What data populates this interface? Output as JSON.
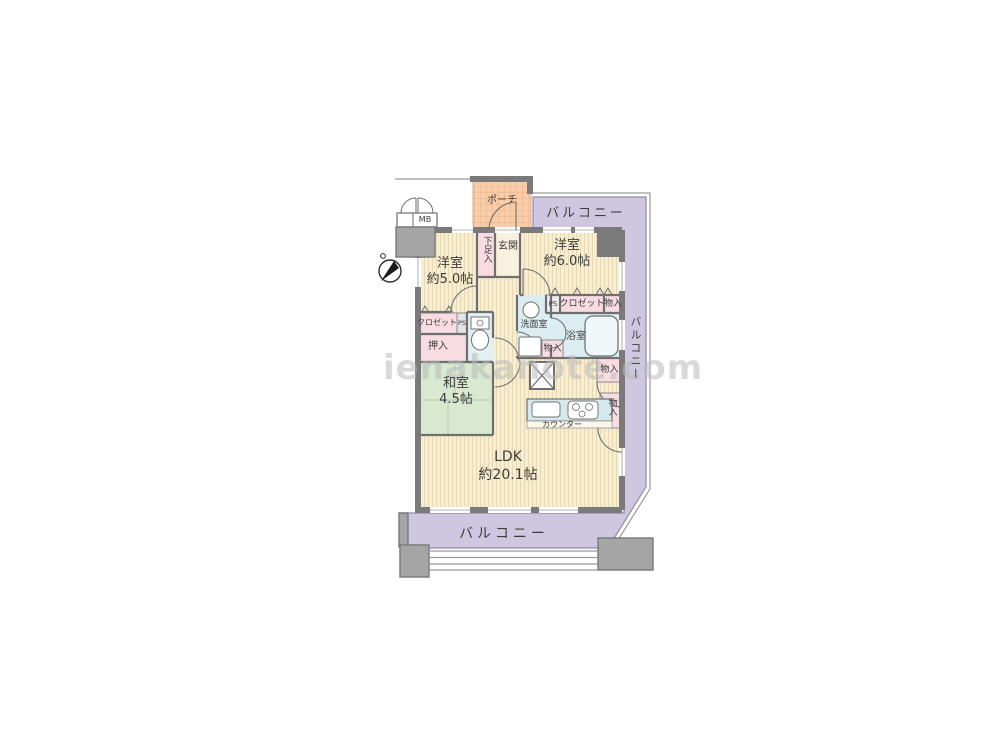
{
  "watermark": "ienakanote.com",
  "rooms": {
    "bedroom1": {
      "name": "洋室",
      "size": "約5.0帖"
    },
    "bedroom2": {
      "name": "洋室",
      "size": "約6.0帖"
    },
    "japanese_room": {
      "name": "和室",
      "size": "4.5帖"
    },
    "ldk": {
      "name": "LDK",
      "size": "約20.1帖"
    },
    "entrance": "玄関",
    "porch": "ポーチ",
    "washroom": "洗面室",
    "bath": "浴室"
  },
  "storage": {
    "shoe_box": "下足入",
    "closet_left": "クロゼット",
    "closet_right": "クロゼット",
    "oshiire": "押入",
    "storage_top_right": "物入",
    "storage_washroom": "物入",
    "storage_mid_right": "物入",
    "storage_kitchen": "物入"
  },
  "balcony": {
    "top": "バルコニー",
    "right": "バルコニー",
    "bottom": "バルコニー"
  },
  "utility": {
    "mb": "MB",
    "ps_left": "PS",
    "ps_right": "PS",
    "counter": "カウンター"
  },
  "colors": {
    "wall": "#7a7a7a",
    "pillar": "#a5a5a5",
    "floor_beige": "#f6edd2",
    "tatami_green": "#d8e9cf",
    "wet_blue": "#dcedf1",
    "closet_pink": "#f9dce2",
    "balcony_purple": "#cfc7e0",
    "porch_orange": "#f9cda9"
  }
}
